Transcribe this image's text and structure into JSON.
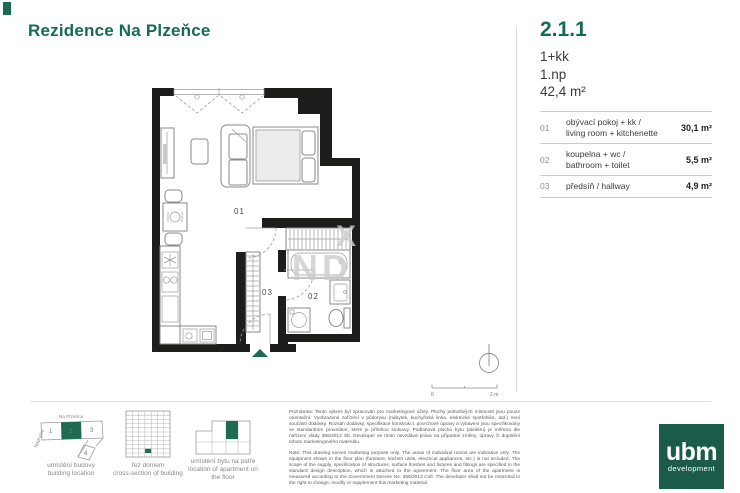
{
  "header": {
    "title": "Rezidence Na Plzeňce"
  },
  "unit": {
    "id": "2.1.1",
    "layout": "1+kk",
    "floor": "1.np",
    "area": "42,4 m²"
  },
  "rooms": [
    {
      "num": "01",
      "name_cs": "obývací pokoj + kk /",
      "name_en": "living room + kitchenette",
      "area": "30,1 m²"
    },
    {
      "num": "02",
      "name_cs": "koupelna + wc /",
      "name_en": "bathroom + toilet",
      "area": "5,5 m²"
    },
    {
      "num": "03",
      "name_cs": "předsíň / hallway",
      "name_en": "",
      "area": "4,9 m²"
    }
  ],
  "plan": {
    "room_labels": {
      "living": "01",
      "bathroom": "02",
      "hallway": "03"
    },
    "scale": {
      "zero": "0",
      "max": "2 m"
    },
    "watermark": {
      "frag1": "X",
      "frag2": "ND"
    }
  },
  "legend": {
    "site": {
      "caption_cs": "umístění budovy",
      "caption_en": "building location",
      "street_top": "Na Plzeňce",
      "street_left": "Nádražní",
      "blocks": [
        "1",
        "2",
        "3",
        "4"
      ],
      "highlighted_block": "2"
    },
    "section": {
      "caption_cs": "řez domem",
      "caption_en": "cross-section of building"
    },
    "floorplate": {
      "caption_cs": "umístění bytu na patře",
      "caption_en": "location of apartment on the floor"
    }
  },
  "note": {
    "cs": "Poznámka: Tento výkres byl zpracován pro marketingové účely. Plochy jednotlivých místností jsou pouze orientační. Vyobrazené zařízení v půdorysu (nábytek, kuchyňská linka, elektrické spotřebiče, atd.) není součástí dodávky. Rozsah dodávky, specifikace konstrukcí, povrchové úpravy a vybavení jsou specifikovány ve standardním provedení, které je přílohou smlouvy. Podlahová plocha bytu (ateliéru) je měřena dle nařízení vlády 366/2013 Sb. Developer se tímto nevzdává práva na případné změny, úpravy či doplnění tohoto marketingového materiálu.",
    "en": "Note: This drawing serves marketing purpose only. The areas of individual rooms are indicative only. The equipment shown in the floor plan (furniture, kitchen units, electrical appliances, etc.) is not included. The scope of the supply, specification of structures, surface finishes and fixtures and fittings are specified in the standard design description, which is attached to the agreement. The floor area of the apartment is measured according to the Government Decree No. 366/2013 Coll. The developer shall not be restricted in the right to change, modify or supplement this marketing material."
  },
  "logo": {
    "name": "ubm",
    "tagline": "development"
  },
  "colors": {
    "brand_green": "#176b52",
    "logo_green": "#1a5c49",
    "wall_black": "#1d1d1b",
    "watermark_gray": "#cdcdcd"
  }
}
